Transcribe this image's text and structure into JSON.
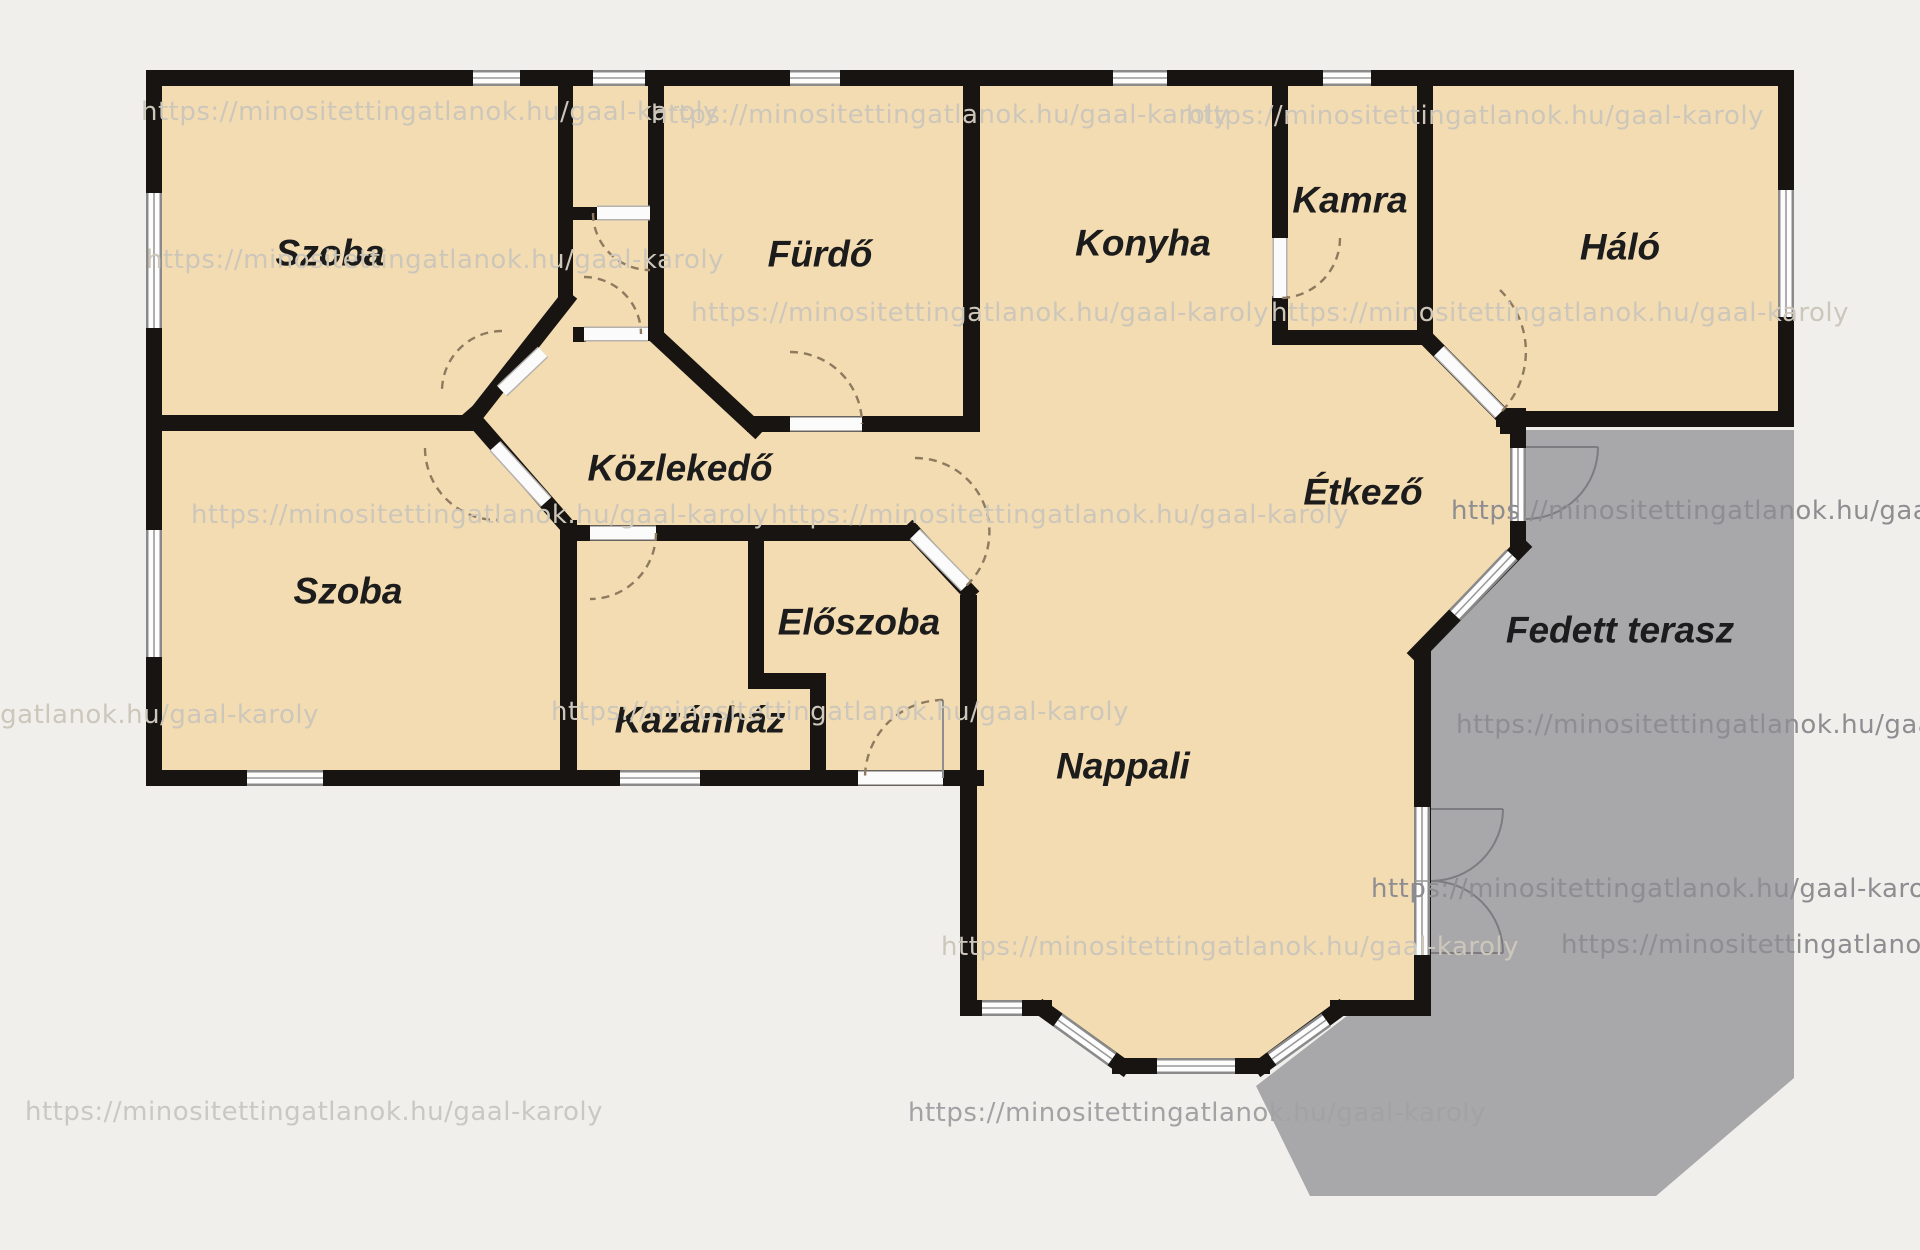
{
  "plan": {
    "title": "Family house floor plan",
    "canvas": {
      "width": 1920,
      "height": 1250
    },
    "colors": {
      "background": "#f0efeb",
      "room_fill": "#f3dcb1",
      "terrace_fill": "#a8a8ab",
      "wall": "#171412",
      "label_text": "#1c1c1c",
      "door_arc": "#8d7a5f"
    }
  },
  "rooms": [
    {
      "id": "szoba-1",
      "label": "Szoba",
      "x": 330,
      "y": 253
    },
    {
      "id": "furdo",
      "label": "Fürdő",
      "x": 820,
      "y": 254
    },
    {
      "id": "konyha",
      "label": "Konyha",
      "x": 1143,
      "y": 243
    },
    {
      "id": "kamra",
      "label": "Kamra",
      "x": 1350,
      "y": 200
    },
    {
      "id": "halo",
      "label": "Háló",
      "x": 1620,
      "y": 247
    },
    {
      "id": "kozlekedo",
      "label": "Közlekedő",
      "x": 680,
      "y": 468
    },
    {
      "id": "szoba-2",
      "label": "Szoba",
      "x": 348,
      "y": 591
    },
    {
      "id": "eloszoba",
      "label": "Előszoba",
      "x": 859,
      "y": 622
    },
    {
      "id": "kazanhaz",
      "label": "Kazánház",
      "x": 700,
      "y": 720
    },
    {
      "id": "etkezo",
      "label": "Étkező",
      "x": 1363,
      "y": 492
    },
    {
      "id": "nappali",
      "label": "Nappali",
      "x": 1123,
      "y": 766
    },
    {
      "id": "fedett-terasz",
      "label": "Fedett terasz",
      "x": 1620,
      "y": 630
    }
  ],
  "watermark": {
    "url": "https://minositettingatlanok.hu/gaal-karoly",
    "instances": [
      {
        "x": 430,
        "y": 112,
        "variant": "light"
      },
      {
        "x": 940,
        "y": 115,
        "variant": "light"
      },
      {
        "x": 1475,
        "y": 116,
        "variant": "light"
      },
      {
        "x": 435,
        "y": 260,
        "variant": "light"
      },
      {
        "x": 980,
        "y": 313,
        "variant": "light"
      },
      {
        "x": 1560,
        "y": 313,
        "variant": "light"
      },
      {
        "x": 480,
        "y": 515,
        "variant": "light"
      },
      {
        "x": 1060,
        "y": 515,
        "variant": "light"
      },
      {
        "x": 1740,
        "y": 511,
        "variant": "dark"
      },
      {
        "x": 30,
        "y": 715,
        "variant": "light"
      },
      {
        "x": 840,
        "y": 712,
        "variant": "light"
      },
      {
        "x": 1745,
        "y": 725,
        "variant": "dark"
      },
      {
        "x": 1230,
        "y": 947,
        "variant": "light"
      },
      {
        "x": 1660,
        "y": 889,
        "variant": "dark"
      },
      {
        "x": 1850,
        "y": 945,
        "variant": "dark"
      },
      {
        "x": 314,
        "y": 1112,
        "variant": "bg"
      },
      {
        "x": 1197,
        "y": 1113,
        "variant": "mix"
      }
    ]
  }
}
